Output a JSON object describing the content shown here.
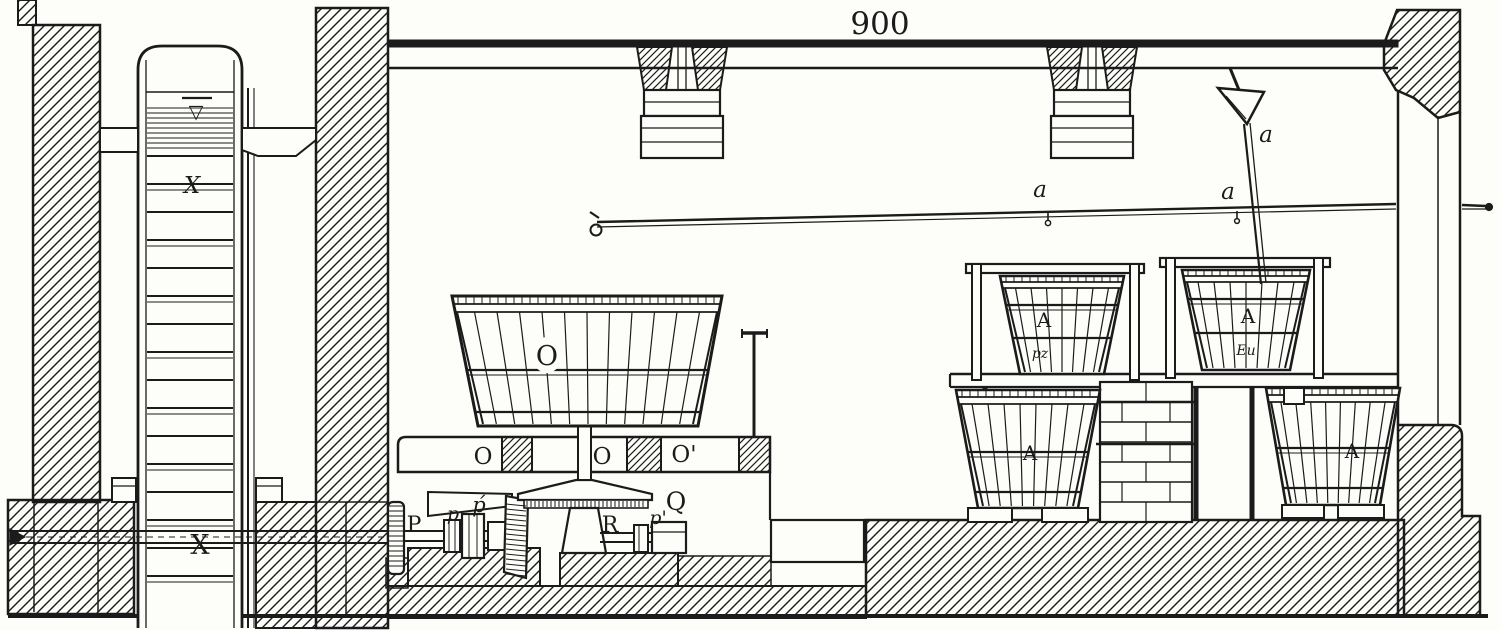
{
  "figure": {
    "kind": "sectional engraving of a works interior (water-wheel, gearing, press vat and tubs)",
    "ink_color": "#1b1b1b",
    "paper_color": "#fdfdfa",
    "dimension_label": "900"
  },
  "labels": {
    "water_wheel": {
      "top_mark": "▽",
      "middle_mark": "X",
      "bottom_mark": "X"
    },
    "press_vat": "O",
    "bench": {
      "left": "O",
      "center": "O",
      "right": "O'"
    },
    "machinery": {
      "wall_gear": "P",
      "coupling_small": "p",
      "coupling_flourish": "ṕ",
      "step_bearing": "R",
      "coupling_prime": "p'",
      "crown_gear": "Q"
    },
    "tubs": {
      "upper_left": "A",
      "upper_left_small": "pz",
      "upper_right": "A",
      "upper_right_small": "Eu",
      "lower_left": "A",
      "lower_right": "A"
    },
    "rod": {
      "mid": "a",
      "near_pipe": "a",
      "at_funnel": "a"
    }
  }
}
